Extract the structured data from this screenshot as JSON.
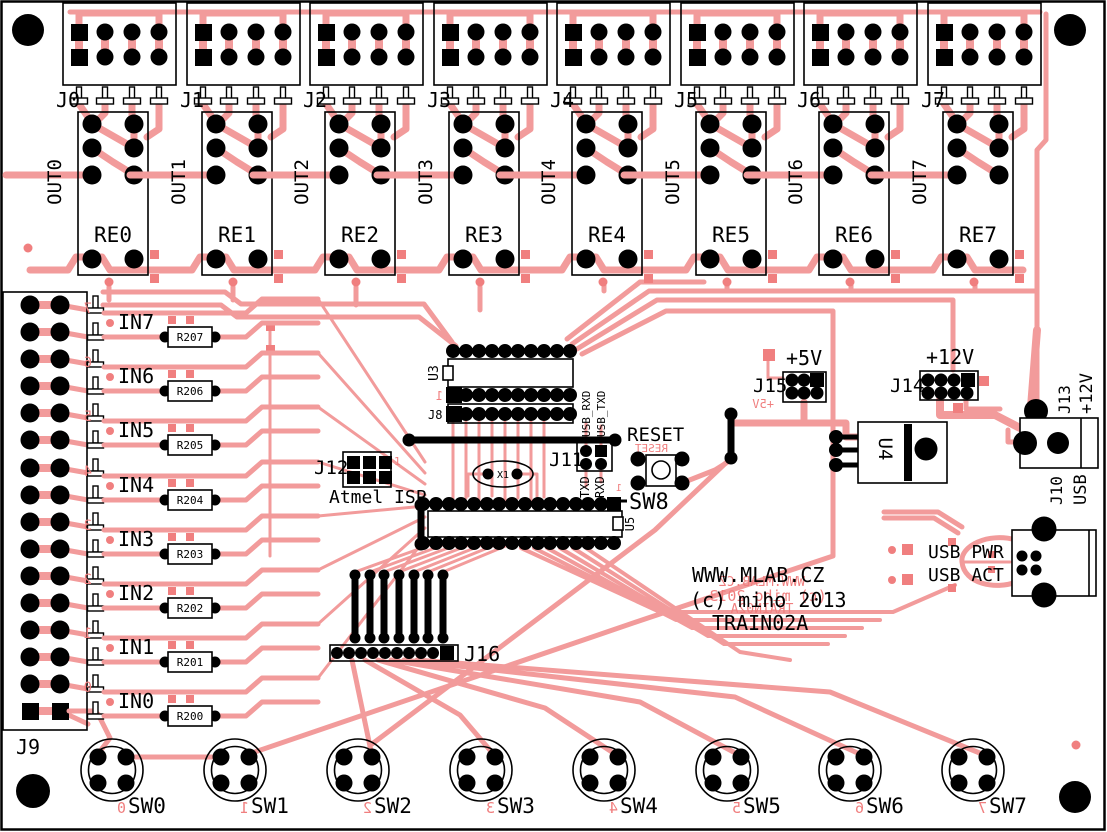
{
  "board": {
    "site": "WWW.MLAB.CZ",
    "copyright": "(c) miho 2013",
    "name": "TRAIN02A",
    "site_mirror": "WWW.MLAB.CZ",
    "copyright_mirror": "(c) miho 2013",
    "name_mirror": "TRAIN02A"
  },
  "channels": [
    {
      "connector": "J0",
      "relay": "RE0",
      "output": "OUT0"
    },
    {
      "connector": "J1",
      "relay": "RE1",
      "output": "OUT1"
    },
    {
      "connector": "J2",
      "relay": "RE2",
      "output": "OUT2"
    },
    {
      "connector": "J3",
      "relay": "RE3",
      "output": "OUT3"
    },
    {
      "connector": "J4",
      "relay": "RE4",
      "output": "OUT4"
    },
    {
      "connector": "J5",
      "relay": "RE5",
      "output": "OUT5"
    },
    {
      "connector": "J6",
      "relay": "RE6",
      "output": "OUT6"
    },
    {
      "connector": "J7",
      "relay": "RE7",
      "output": "OUT7"
    }
  ],
  "inputs": [
    {
      "label": "IN7",
      "resistor": "R207",
      "digit": "7"
    },
    {
      "label": "IN6",
      "resistor": "R206",
      "digit": "6"
    },
    {
      "label": "IN5",
      "resistor": "R205",
      "digit": "5"
    },
    {
      "label": "IN4",
      "resistor": "R204",
      "digit": "4"
    },
    {
      "label": "IN3",
      "resistor": "R203",
      "digit": "3"
    },
    {
      "label": "IN2",
      "resistor": "R202",
      "digit": "2"
    },
    {
      "label": "IN1",
      "resistor": "R201",
      "digit": "1"
    },
    {
      "label": "IN0",
      "resistor": "R200",
      "digit": "0"
    }
  ],
  "j9": "J9",
  "switches": [
    {
      "label": "SW0",
      "digit": "0"
    },
    {
      "label": "SW1",
      "digit": "1"
    },
    {
      "label": "SW2",
      "digit": "2"
    },
    {
      "label": "SW3",
      "digit": "3"
    },
    {
      "label": "SW4",
      "digit": "4"
    },
    {
      "label": "SW5",
      "digit": "5"
    },
    {
      "label": "SW6",
      "digit": "6"
    },
    {
      "label": "SW7",
      "digit": "7"
    }
  ],
  "center": {
    "u3": "U3",
    "pin1": "1",
    "j8": "J8",
    "j12": "J12",
    "j12_pin1": "1",
    "isp": "Atmel ISP",
    "x1": "X1",
    "j11": "J11",
    "usb_rxd": "USB_RXD",
    "usb_txd": "USB_TXD",
    "txd": "TXD",
    "rxd": "RXD",
    "reset": "RESET",
    "reset_mirror": "RESET",
    "sw8": "SW8",
    "sw8_pin1": "1",
    "u5": "U5",
    "j16": "J16"
  },
  "power": {
    "plus5": "+5V",
    "plus5_mirror": "+5V",
    "j15": "J15",
    "plus12": "+12V",
    "j14": "J14",
    "u4": "U4",
    "j13": "J13",
    "j13_voltage": "+12V",
    "j10": "J10",
    "j10_type": "USB",
    "usb_pwr": "USB PWR",
    "usb_act": "USB ACT"
  }
}
